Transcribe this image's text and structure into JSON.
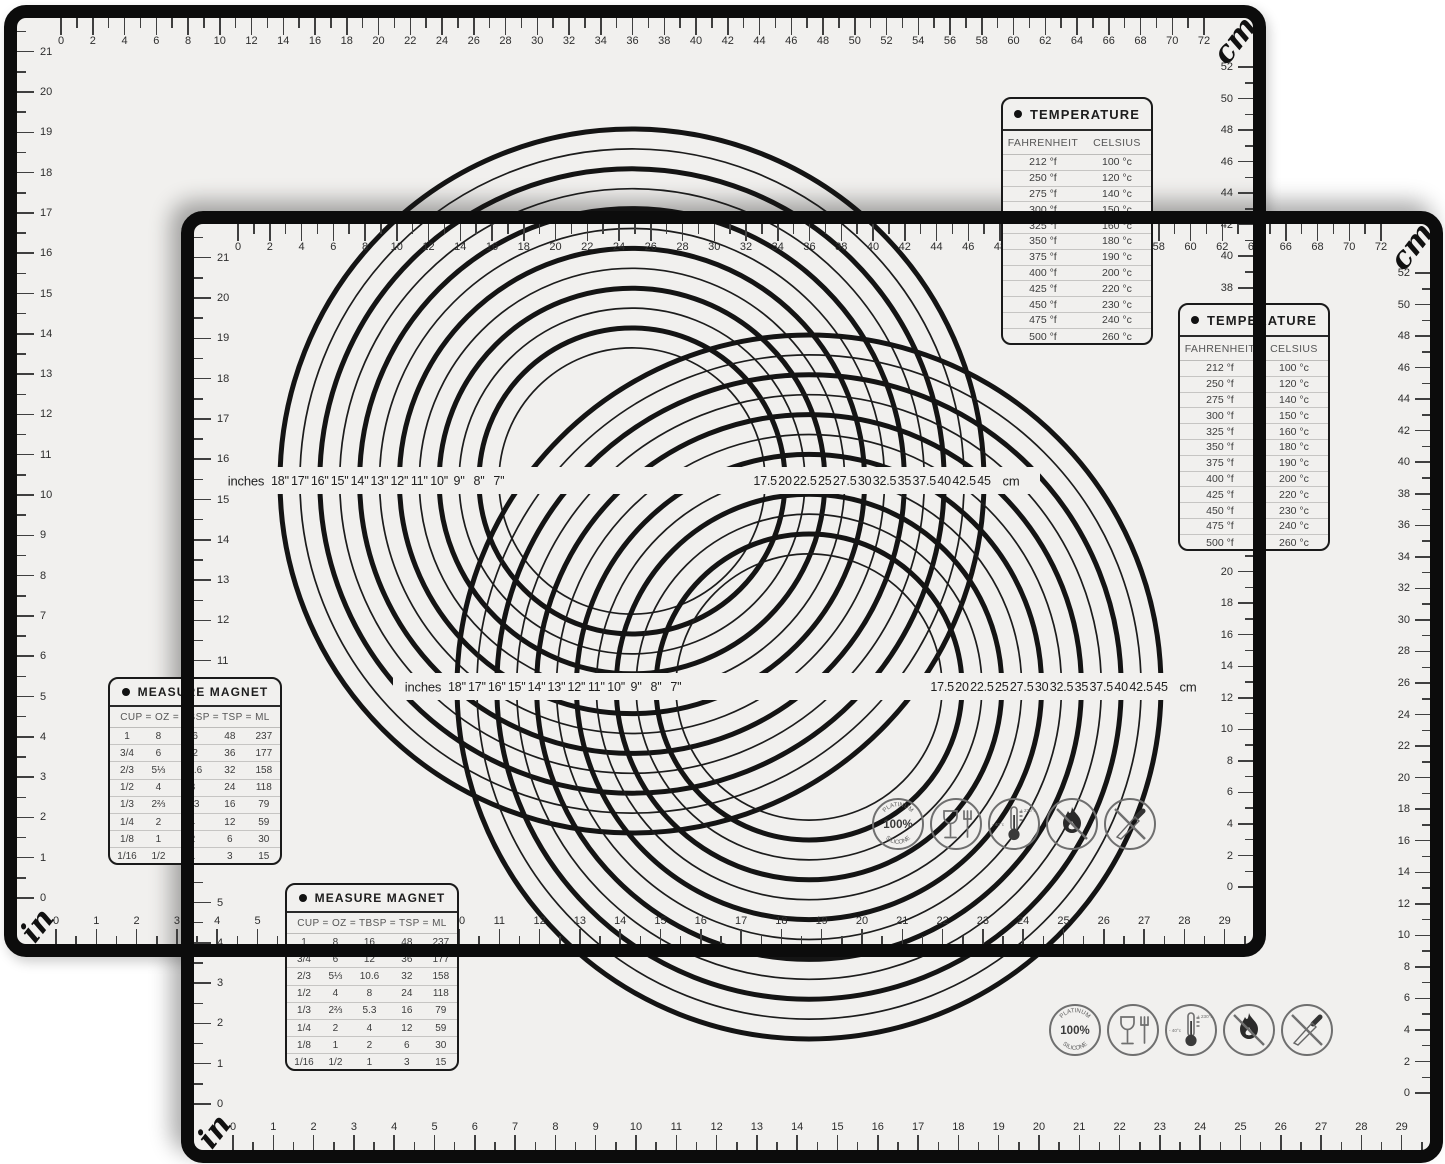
{
  "mat": {
    "colors": {
      "surface": "#f1f0ee",
      "frame": "#0c0c0c",
      "ink": "#3f3f3f"
    },
    "top_ruler": {
      "unit_label": "cm",
      "labels": [
        0,
        2,
        4,
        6,
        8,
        10,
        12,
        14,
        16,
        18,
        20,
        22,
        24,
        26,
        28,
        30,
        32,
        34,
        36,
        38,
        40,
        42,
        44,
        46,
        48,
        50,
        52,
        54,
        56,
        58,
        60,
        62,
        64,
        66,
        68,
        70,
        72
      ]
    },
    "right_ruler": {
      "labels": [
        52,
        50,
        48,
        46,
        44,
        42,
        40,
        38,
        36,
        34,
        32,
        30,
        28,
        26,
        24,
        22,
        20,
        18,
        16,
        14,
        12,
        10,
        8,
        6,
        4,
        2,
        0
      ]
    },
    "left_ruler": {
      "labels": [
        21,
        20,
        19,
        18,
        17,
        16,
        15,
        14,
        13,
        12,
        11,
        10,
        9,
        8,
        7,
        6,
        5,
        4,
        3,
        2,
        1,
        0
      ]
    },
    "bottom_ruler": {
      "unit_label": "in",
      "labels": [
        0,
        1,
        2,
        3,
        4,
        5,
        6,
        7,
        8,
        9,
        10,
        11,
        12,
        13,
        14,
        15,
        16,
        17,
        18,
        19,
        20,
        21,
        22,
        23,
        24,
        25,
        26,
        27,
        28,
        29
      ]
    },
    "circle_guide": {
      "prefix_label": "inches",
      "suffix_label": "cm",
      "rings": [
        {
          "inches": "18''",
          "cm": "45"
        },
        {
          "inches": "17''",
          "cm": "42.5"
        },
        {
          "inches": "16''",
          "cm": "40"
        },
        {
          "inches": "15''",
          "cm": "37.5"
        },
        {
          "inches": "14''",
          "cm": "35"
        },
        {
          "inches": "13''",
          "cm": "32.5"
        },
        {
          "inches": "12''",
          "cm": "30"
        },
        {
          "inches": "11''",
          "cm": "27.5"
        },
        {
          "inches": "10''",
          "cm": "25"
        },
        {
          "inches": "9''",
          "cm": "22.5"
        },
        {
          "inches": "8''",
          "cm": "20"
        },
        {
          "inches": "7''",
          "cm": "17.5"
        }
      ]
    },
    "temperature_table": {
      "title": "TEMPERATURE",
      "columns": [
        "FAHRENHEIT",
        "CELSIUS"
      ],
      "rows": [
        [
          "212 °f",
          "100 °c"
        ],
        [
          "250 °f",
          "120 °c"
        ],
        [
          "275 °f",
          "140 °c"
        ],
        [
          "300 °f",
          "150 °c"
        ],
        [
          "325 °f",
          "160 °c"
        ],
        [
          "350 °f",
          "180 °c"
        ],
        [
          "375 °f",
          "190 °c"
        ],
        [
          "400 °f",
          "200 °c"
        ],
        [
          "425 °f",
          "220 °c"
        ],
        [
          "450 °f",
          "230 °c"
        ],
        [
          "475 °f",
          "240 °c"
        ],
        [
          "500 °f",
          "260 °c"
        ]
      ]
    },
    "measure_table": {
      "title": "MEASURE MAGNET",
      "columns": [
        "CUP",
        "OZ",
        "TBSP",
        "TSP",
        "ML"
      ],
      "joiner": "=",
      "rows": [
        [
          "1",
          "8",
          "16",
          "48",
          "237"
        ],
        [
          "3/4",
          "6",
          "12",
          "36",
          "177"
        ],
        [
          "2/3",
          "5⅓",
          "10.6",
          "32",
          "158"
        ],
        [
          "1/2",
          "4",
          "8",
          "24",
          "118"
        ],
        [
          "1/3",
          "2⅔",
          "5.3",
          "16",
          "79"
        ],
        [
          "1/4",
          "2",
          "4",
          "12",
          "59"
        ],
        [
          "1/8",
          "1",
          "2",
          "6",
          "30"
        ],
        [
          "1/16",
          "1/2",
          "1",
          "3",
          "15"
        ]
      ]
    },
    "certification_icons": {
      "badge": {
        "top": "PLATINUM",
        "center": "100%",
        "bottom": "SILICONE"
      },
      "temperature_range": {
        "min": "- 40°c",
        "max": "+ 230°c"
      }
    }
  }
}
